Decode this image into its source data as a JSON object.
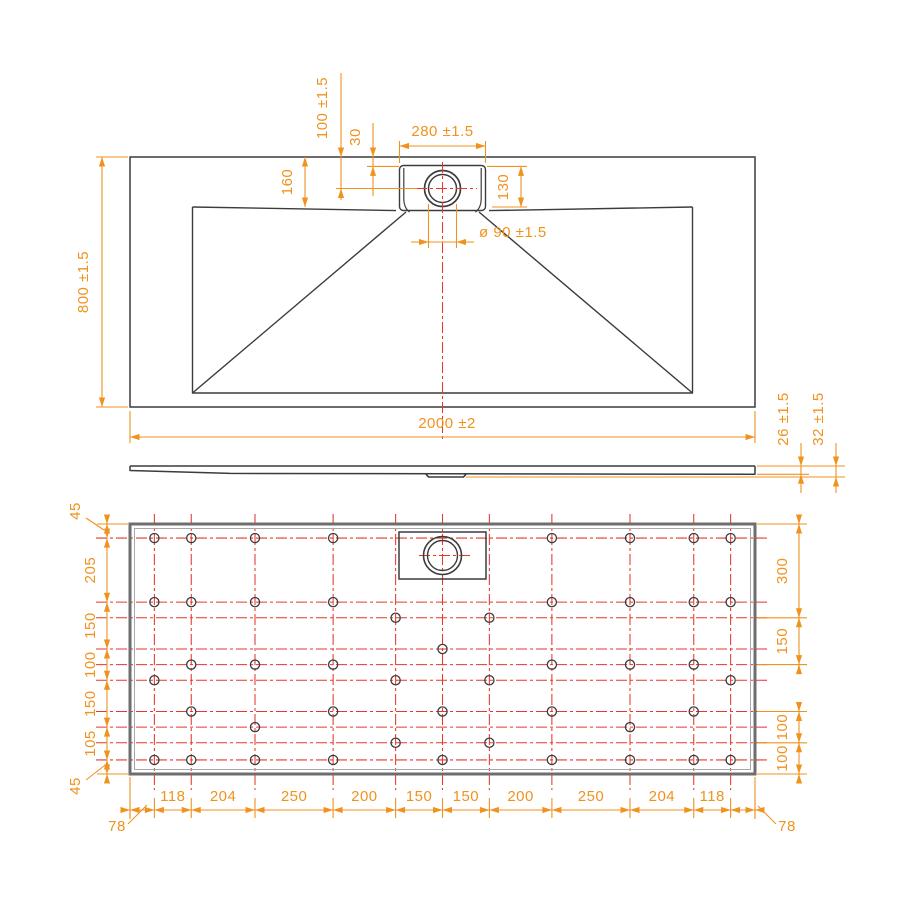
{
  "drawing": {
    "kind": "technical-drawing",
    "subject": "rectangular shower tray with central drain",
    "views": [
      "top",
      "side-profile",
      "bottom"
    ]
  },
  "colors": {
    "outline": "#3c3c3c",
    "thick_outline": "#6e6e6e",
    "inner_outline": "#a8a8a8",
    "dimension": "#f0921e",
    "centerline": "#e8362c",
    "background": "#ffffff"
  },
  "top_view": {
    "length": "2000 ±2",
    "width": "800 ±1.5",
    "drain_center_offset": "100 ±1.5",
    "recess_top_offset": "30",
    "recess_length": "280 ±1.5",
    "rim_depth": "160",
    "recess_width": "130",
    "drain_diameter": "ø 90 ±1.5"
  },
  "side_view": {
    "thickness": "26 ±1.5",
    "overall_thickness": "32 ±1.5"
  },
  "bottom_view": {
    "tray_mm": [
      2000,
      800
    ],
    "left_chain": [
      "45",
      "205",
      "150",
      "100",
      "150",
      "105",
      "45"
    ],
    "right_chain": [
      "300",
      "150",
      "100",
      "100"
    ],
    "bottom_chain": [
      "78",
      "118",
      "204",
      "250",
      "200",
      "150",
      "150",
      "200",
      "250",
      "204",
      "118",
      "78"
    ],
    "grid_columns_mm": [
      78,
      196,
      400,
      650,
      850,
      1000,
      1150,
      1350,
      1600,
      1804,
      1922
    ],
    "grid_rows_mm": [
      45,
      250,
      300,
      400,
      450,
      500,
      600,
      650,
      700,
      755
    ],
    "feet_mm": [
      [
        78,
        45
      ],
      [
        196,
        45
      ],
      [
        400,
        45
      ],
      [
        650,
        45
      ],
      [
        1350,
        45
      ],
      [
        1600,
        45
      ],
      [
        1804,
        45
      ],
      [
        1922,
        45
      ],
      [
        78,
        250
      ],
      [
        196,
        250
      ],
      [
        400,
        250
      ],
      [
        650,
        250
      ],
      [
        1350,
        250
      ],
      [
        1600,
        250
      ],
      [
        1804,
        250
      ],
      [
        1922,
        250
      ],
      [
        850,
        300
      ],
      [
        1150,
        300
      ],
      [
        1000,
        400
      ],
      [
        196,
        450
      ],
      [
        400,
        450
      ],
      [
        650,
        450
      ],
      [
        1350,
        450
      ],
      [
        1600,
        450
      ],
      [
        1804,
        450
      ],
      [
        78,
        500
      ],
      [
        850,
        500
      ],
      [
        1150,
        500
      ],
      [
        1922,
        500
      ],
      [
        196,
        600
      ],
      [
        650,
        600
      ],
      [
        1000,
        600
      ],
      [
        1350,
        600
      ],
      [
        1804,
        600
      ],
      [
        400,
        650
      ],
      [
        1600,
        650
      ],
      [
        850,
        700
      ],
      [
        1150,
        700
      ],
      [
        78,
        755
      ],
      [
        196,
        755
      ],
      [
        400,
        755
      ],
      [
        650,
        755
      ],
      [
        1000,
        755
      ],
      [
        1350,
        755
      ],
      [
        1600,
        755
      ],
      [
        1804,
        755
      ],
      [
        1922,
        755
      ]
    ]
  }
}
